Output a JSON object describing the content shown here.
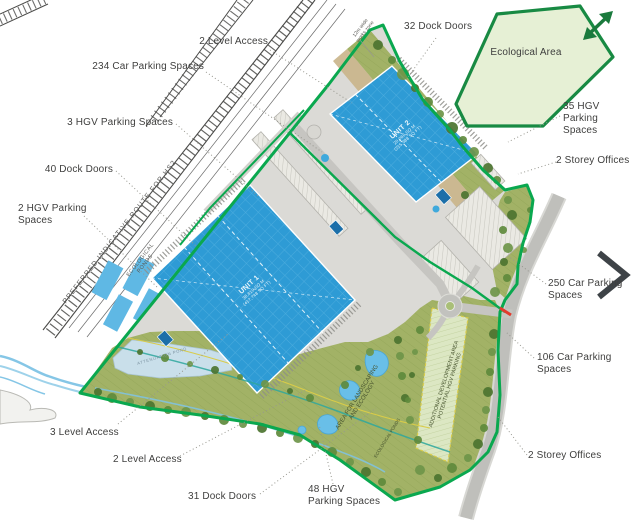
{
  "plan": {
    "callouts": {
      "level_access_top": "2 Level Access",
      "car_parking_234": "234 Car Parking Spaces",
      "hgv_parking_3": "3 HGV Parking Spaces",
      "dock_doors_40": "40 Dock Doors",
      "hgv_parking_2": "2 HGV Parking Spaces",
      "dock_doors_32": "32 Dock Doors",
      "hgv_parking_35": "35 HGV Parking Spaces",
      "storey_offices_upper": "2 Storey Offices",
      "car_parking_250": "250 Car Parking Spaces",
      "car_parking_106": "106 Car Parking Spaces",
      "storey_offices_lower": "2 Storey Offices",
      "level_access_3": "3 Level Access",
      "level_access_2_bottom": "2 Level Access",
      "dock_doors_31": "31 Dock Doors",
      "hgv_parking_48": "48 HGV Parking Spaces"
    },
    "areas": {
      "ecological_area": "Ecological Area",
      "landscaping_area": "AREA FOR LANDSCAPING AND ECOLOGY",
      "additional_development": "ADDITIONAL DEVELOPMENT AREA POTENTIAL HGV PARKING",
      "ecological_ponds_hs2": "ECOLOGICAL PONDS",
      "ecological_ponds_south": "ECOLOGICAL PONDS",
      "attenuation_pond": "ATTENUATION POND",
      "works_zone": "12m wide works zone",
      "hs2_route": "PREFERRED INDICATIVE ROUTE FOR HS2"
    },
    "units": {
      "unit1": {
        "name": "UNIT 1",
        "area_sqm": "38,810 SQ M",
        "area_sqft": "(417,748 SQ FT)"
      },
      "unit2": {
        "name": "UNIT 2",
        "area_sqm": "20,066 SQ M",
        "area_sqft": "(215,988 SQ FT)"
      }
    },
    "colors": {
      "boundary_green": "#0AA84F",
      "building_blue": "#2E9BD5",
      "eco_area_fill": "#E6F0D5",
      "landscape_olive": "#A2B266",
      "pond_blue": "#69BFE8",
      "label_grey": "#3F3F3E",
      "arrow_green": "#1A7A3D",
      "arrow_grey": "#3E4347",
      "access_red": "#E23B2E"
    }
  }
}
